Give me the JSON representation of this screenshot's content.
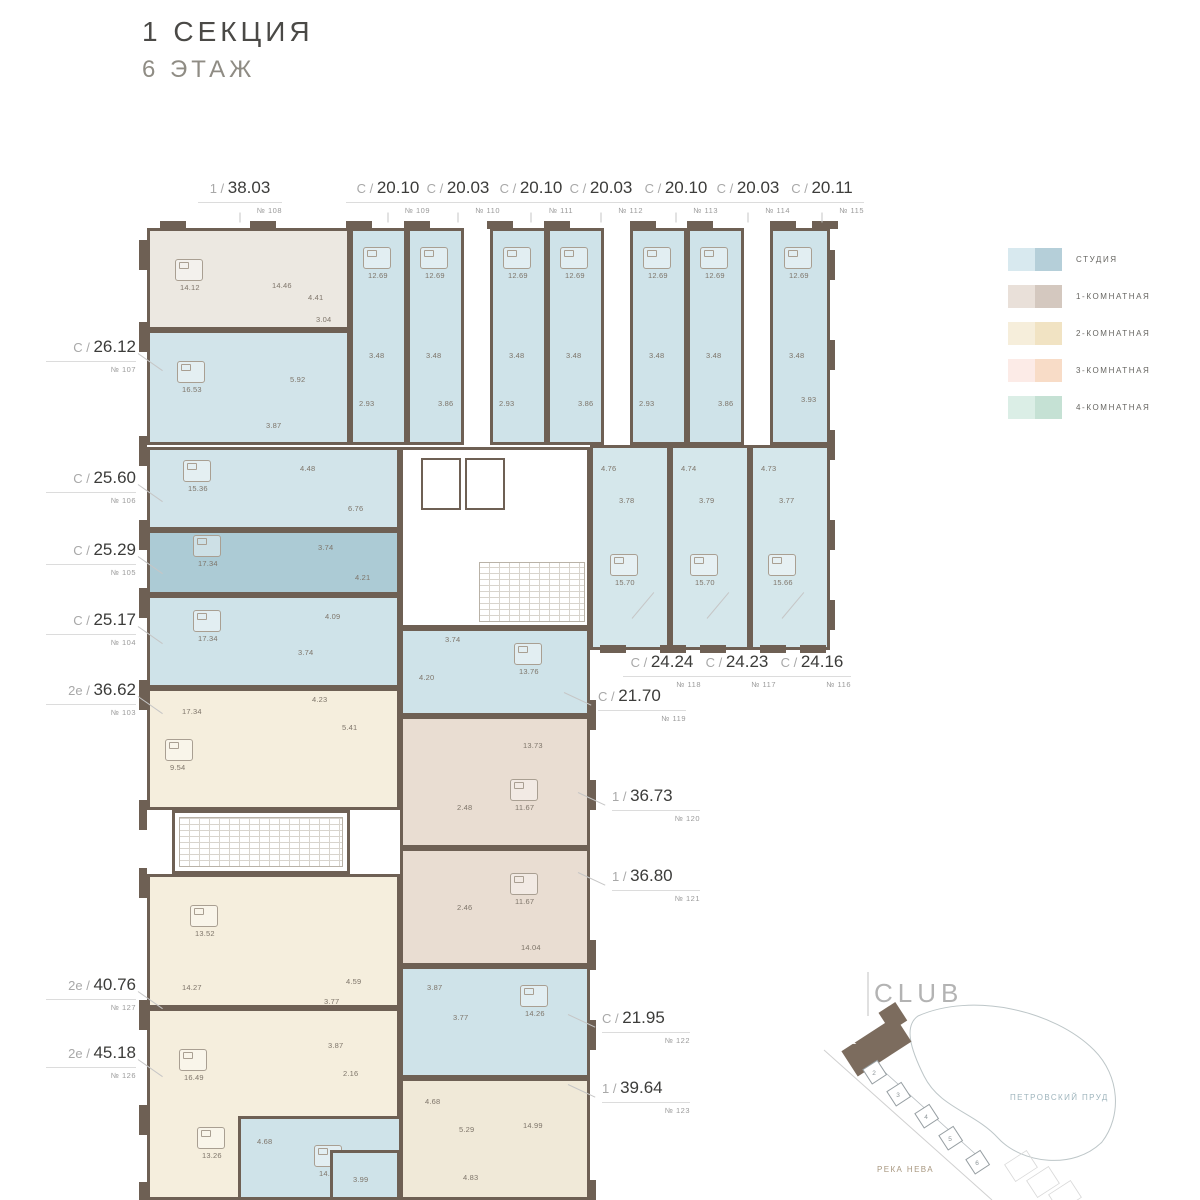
{
  "title": {
    "section": "1 СЕКЦИЯ",
    "floor": "6 ЭТАЖ"
  },
  "legend": [
    {
      "label": "СТУДИЯ",
      "colors": [
        "#d8e9ef",
        "#b5cfd9"
      ]
    },
    {
      "label": "1-КОМНАТНАЯ",
      "colors": [
        "#e9e0d9",
        "#d4c8bf"
      ]
    },
    {
      "label": "2-КОМНАТНАЯ",
      "colors": [
        "#f6eedb",
        "#f1e3c3"
      ]
    },
    {
      "label": "3-КОМНАТНАЯ",
      "colors": [
        "#fcebe7",
        "#f8dcc7"
      ]
    },
    {
      "label": "4-КОМНАТНАЯ",
      "colors": [
        "#dbeee6",
        "#c5e1d4"
      ]
    }
  ],
  "units": {
    "top": [
      {
        "id": "108",
        "prefix": "1",
        "area": "38.03",
        "num": "№ 108",
        "x": 240
      },
      {
        "id": "109",
        "prefix": "С",
        "area": "20.10",
        "num": "№ 109",
        "x": 388
      },
      {
        "id": "110",
        "prefix": "С",
        "area": "20.03",
        "num": "№ 110",
        "x": 458
      },
      {
        "id": "111",
        "prefix": "С",
        "area": "20.10",
        "num": "№ 111",
        "x": 531
      },
      {
        "id": "112",
        "prefix": "С",
        "area": "20.03",
        "num": "№ 112",
        "x": 601
      },
      {
        "id": "113",
        "prefix": "С",
        "area": "20.10",
        "num": "№ 113",
        "x": 676
      },
      {
        "id": "114",
        "prefix": "С",
        "area": "20.03",
        "num": "№ 114",
        "x": 748
      },
      {
        "id": "115",
        "prefix": "С",
        "area": "20.11",
        "num": "№ 115",
        "x": 822
      }
    ],
    "left": [
      {
        "id": "107",
        "prefix": "С",
        "area": "26.12",
        "num": "№ 107",
        "y": 337
      },
      {
        "id": "106",
        "prefix": "С",
        "area": "25.60",
        "num": "№ 106",
        "y": 468
      },
      {
        "id": "105",
        "prefix": "С",
        "area": "25.29",
        "num": "№ 105",
        "y": 540
      },
      {
        "id": "104",
        "prefix": "С",
        "area": "25.17",
        "num": "№ 104",
        "y": 610
      },
      {
        "id": "103",
        "prefix": "2е",
        "area": "36.62",
        "num": "№ 103",
        "y": 680
      },
      {
        "id": "127",
        "prefix": "2е",
        "area": "40.76",
        "num": "№ 127",
        "y": 975
      },
      {
        "id": "126",
        "prefix": "2е",
        "area": "45.18",
        "num": "№ 126",
        "y": 1043
      }
    ],
    "right_row": [
      {
        "id": "118",
        "prefix": "С",
        "area": "24.24",
        "num": "№ 118",
        "x": 662,
        "y": 652
      },
      {
        "id": "117",
        "prefix": "С",
        "area": "24.23",
        "num": "№ 117",
        "x": 737,
        "y": 652
      },
      {
        "id": "116",
        "prefix": "С",
        "area": "24.16",
        "num": "№ 116",
        "x": 812,
        "y": 652
      }
    ],
    "right_col": [
      {
        "id": "119",
        "prefix": "С",
        "area": "21.70",
        "num": "№ 119",
        "x": 598,
        "y": 686
      },
      {
        "id": "120",
        "prefix": "1",
        "area": "36.73",
        "num": "№ 120",
        "x": 612,
        "y": 786
      },
      {
        "id": "121",
        "prefix": "1",
        "area": "36.80",
        "num": "№ 121",
        "x": 612,
        "y": 866
      },
      {
        "id": "122",
        "prefix": "С",
        "area": "21.95",
        "num": "№ 122",
        "x": 602,
        "y": 1008
      },
      {
        "id": "123",
        "prefix": "1",
        "area": "39.64",
        "num": "№ 123",
        "x": 602,
        "y": 1078
      }
    ]
  },
  "plan": {
    "wall": "#6e6054",
    "blocks": [
      {
        "id": "108",
        "color": "#ece8e1",
        "x": 147,
        "y": 228,
        "w": 203,
        "h": 102,
        "rooms": [
          {
            "v": "14.12",
            "x": 30,
            "y": 52,
            "bed": true
          },
          {
            "v": "14.46",
            "x": 122,
            "y": 50
          },
          {
            "v": "4.41",
            "x": 158,
            "y": 62
          },
          {
            "v": "3.04",
            "x": 166,
            "y": 84
          }
        ]
      },
      {
        "id": "107",
        "color": "#d2e4ea",
        "x": 147,
        "y": 330,
        "w": 203,
        "h": 115,
        "rooms": [
          {
            "v": "16.53",
            "x": 32,
            "y": 52,
            "bed": true
          },
          {
            "v": "5.92",
            "x": 140,
            "y": 42
          },
          {
            "v": "3.87",
            "x": 116,
            "y": 88
          }
        ]
      },
      {
        "id": "109",
        "color": "#cfe3e9",
        "x": 350,
        "y": 228,
        "w": 57,
        "h": 217,
        "rooms": [
          {
            "v": "12.69",
            "x": 15,
            "y": 40,
            "bed": true
          },
          {
            "v": "3.48",
            "x": 16,
            "y": 120
          },
          {
            "v": "2.93",
            "x": 6,
            "y": 168
          }
        ]
      },
      {
        "id": "110",
        "color": "#cfe3e9",
        "x": 407,
        "y": 228,
        "w": 57,
        "h": 217,
        "rooms": [
          {
            "v": "12.69",
            "x": 15,
            "y": 40,
            "bed": true
          },
          {
            "v": "3.48",
            "x": 16,
            "y": 120
          },
          {
            "v": "3.86",
            "x": 28,
            "y": 168
          }
        ]
      },
      {
        "id": "111",
        "color": "#cfe3e9",
        "x": 490,
        "y": 228,
        "w": 57,
        "h": 217,
        "rooms": [
          {
            "v": "12.69",
            "x": 15,
            "y": 40,
            "bed": true
          },
          {
            "v": "3.48",
            "x": 16,
            "y": 120
          },
          {
            "v": "2.93",
            "x": 6,
            "y": 168
          }
        ]
      },
      {
        "id": "112",
        "color": "#cfe3e9",
        "x": 547,
        "y": 228,
        "w": 57,
        "h": 217,
        "rooms": [
          {
            "v": "12.69",
            "x": 15,
            "y": 40,
            "bed": true
          },
          {
            "v": "3.48",
            "x": 16,
            "y": 120
          },
          {
            "v": "3.86",
            "x": 28,
            "y": 168
          }
        ]
      },
      {
        "id": "113",
        "color": "#cfe3e9",
        "x": 630,
        "y": 228,
        "w": 57,
        "h": 217,
        "rooms": [
          {
            "v": "12.69",
            "x": 15,
            "y": 40,
            "bed": true
          },
          {
            "v": "3.48",
            "x": 16,
            "y": 120
          },
          {
            "v": "2.93",
            "x": 6,
            "y": 168
          }
        ]
      },
      {
        "id": "114",
        "color": "#cfe3e9",
        "x": 687,
        "y": 228,
        "w": 57,
        "h": 217,
        "rooms": [
          {
            "v": "12.69",
            "x": 15,
            "y": 40,
            "bed": true
          },
          {
            "v": "3.48",
            "x": 16,
            "y": 120
          },
          {
            "v": "3.86",
            "x": 28,
            "y": 168
          }
        ]
      },
      {
        "id": "115",
        "color": "#cfe3e9",
        "x": 770,
        "y": 228,
        "w": 60,
        "h": 217,
        "rooms": [
          {
            "v": "12.69",
            "x": 16,
            "y": 40,
            "bed": true
          },
          {
            "v": "3.48",
            "x": 16,
            "y": 120
          },
          {
            "v": "3.93",
            "x": 28,
            "y": 164
          }
        ]
      },
      {
        "id": "118",
        "color": "#d5e7eb",
        "x": 590,
        "y": 445,
        "w": 80,
        "h": 205,
        "rooms": [
          {
            "v": "4.76",
            "x": 8,
            "y": 16
          },
          {
            "v": "3.78",
            "x": 26,
            "y": 48
          },
          {
            "v": "15.70",
            "x": 22,
            "y": 130,
            "bed": true
          }
        ]
      },
      {
        "id": "117",
        "color": "#d5e7eb",
        "x": 670,
        "y": 445,
        "w": 80,
        "h": 205,
        "rooms": [
          {
            "v": "4.74",
            "x": 8,
            "y": 16
          },
          {
            "v": "3.79",
            "x": 26,
            "y": 48
          },
          {
            "v": "15.70",
            "x": 22,
            "y": 130,
            "bed": true
          }
        ]
      },
      {
        "id": "116",
        "color": "#d5e7eb",
        "x": 750,
        "y": 445,
        "w": 80,
        "h": 205,
        "rooms": [
          {
            "v": "4.73",
            "x": 8,
            "y": 16
          },
          {
            "v": "3.77",
            "x": 26,
            "y": 48
          },
          {
            "v": "15.66",
            "x": 20,
            "y": 130,
            "bed": true
          }
        ]
      },
      {
        "id": "106",
        "color": "#d2e4ea",
        "x": 147,
        "y": 447,
        "w": 253,
        "h": 83,
        "rooms": [
          {
            "v": "15.36",
            "x": 38,
            "y": 34,
            "bed": true
          },
          {
            "v": "4.48",
            "x": 150,
            "y": 14
          },
          {
            "v": "6.76",
            "x": 198,
            "y": 54
          }
        ]
      },
      {
        "id": "105",
        "color": "#accbd5",
        "x": 147,
        "y": 530,
        "w": 253,
        "h": 65,
        "rooms": [
          {
            "v": "17.34",
            "x": 48,
            "y": 26,
            "bed": true
          },
          {
            "v": "3.74",
            "x": 168,
            "y": 10
          },
          {
            "v": "4.21",
            "x": 205,
            "y": 40
          }
        ]
      },
      {
        "id": "104",
        "color": "#cfe3e9",
        "x": 147,
        "y": 595,
        "w": 253,
        "h": 93,
        "rooms": [
          {
            "v": "17.34",
            "x": 48,
            "y": 36,
            "bed": true
          },
          {
            "v": "4.09",
            "x": 175,
            "y": 14
          },
          {
            "v": "3.74",
            "x": 148,
            "y": 50
          }
        ]
      },
      {
        "id": "103",
        "color": "#f5eedd",
        "x": 147,
        "y": 688,
        "w": 253,
        "h": 122,
        "rooms": [
          {
            "v": "17.34",
            "x": 32,
            "y": 16
          },
          {
            "v": "4.23",
            "x": 162,
            "y": 4
          },
          {
            "v": "5.41",
            "x": 192,
            "y": 32
          },
          {
            "v": "9.54",
            "x": 20,
            "y": 72,
            "bed": true
          }
        ]
      },
      {
        "id": "127",
        "color": "#f5eedd",
        "x": 147,
        "y": 874,
        "w": 253,
        "h": 134,
        "rooms": [
          {
            "v": "13.52",
            "x": 45,
            "y": 52,
            "bed": true
          },
          {
            "v": "14.27",
            "x": 32,
            "y": 106
          },
          {
            "v": "4.59",
            "x": 196,
            "y": 100
          },
          {
            "v": "3.77",
            "x": 174,
            "y": 120
          }
        ]
      },
      {
        "id": "126",
        "color": "#f5eedd",
        "x": 147,
        "y": 1008,
        "w": 253,
        "h": 192,
        "rooms": [
          {
            "v": "16.49",
            "x": 34,
            "y": 62,
            "bed": true
          },
          {
            "v": "3.87",
            "x": 178,
            "y": 30
          },
          {
            "v": "2.16",
            "x": 193,
            "y": 58
          },
          {
            "v": "13.26",
            "x": 52,
            "y": 140,
            "bed": true
          }
        ]
      },
      {
        "id": "core",
        "color": "#ffffff",
        "x": 400,
        "y": 447,
        "w": 190,
        "h": 181,
        "core": true
      },
      {
        "id": "stair2",
        "color": "#ffffff",
        "x": 172,
        "y": 810,
        "w": 178,
        "h": 64,
        "stairwell": true
      },
      {
        "id": "119",
        "color": "#cfe3e9",
        "x": 400,
        "y": 628,
        "w": 190,
        "h": 88,
        "rooms": [
          {
            "v": "3.74",
            "x": 42,
            "y": 4
          },
          {
            "v": "4.20",
            "x": 16,
            "y": 42
          },
          {
            "v": "13.76",
            "x": 116,
            "y": 36,
            "bed": true
          }
        ]
      },
      {
        "id": "120",
        "color": "#e9ddd2",
        "x": 400,
        "y": 716,
        "w": 190,
        "h": 132,
        "rooms": [
          {
            "v": "13.73",
            "x": 120,
            "y": 22
          },
          {
            "v": "2.48",
            "x": 54,
            "y": 84
          },
          {
            "v": "11.67",
            "x": 112,
            "y": 84,
            "bed": true
          }
        ]
      },
      {
        "id": "121",
        "color": "#e9ddd2",
        "x": 400,
        "y": 848,
        "w": 190,
        "h": 118,
        "rooms": [
          {
            "v": "2.46",
            "x": 54,
            "y": 52
          },
          {
            "v": "11.67",
            "x": 112,
            "y": 46,
            "bed": true
          },
          {
            "v": "14.04",
            "x": 118,
            "y": 92
          }
        ]
      },
      {
        "id": "122",
        "color": "#cfe3e9",
        "x": 400,
        "y": 966,
        "w": 190,
        "h": 112,
        "rooms": [
          {
            "v": "3.87",
            "x": 24,
            "y": 14
          },
          {
            "v": "3.77",
            "x": 50,
            "y": 44
          },
          {
            "v": "14.26",
            "x": 122,
            "y": 40,
            "bed": true
          }
        ]
      },
      {
        "id": "123",
        "color": "#f0e9d8",
        "x": 400,
        "y": 1078,
        "w": 190,
        "h": 122,
        "rooms": [
          {
            "v": "4.68",
            "x": 22,
            "y": 16
          },
          {
            "v": "5.29",
            "x": 56,
            "y": 44
          },
          {
            "v": "14.99",
            "x": 120,
            "y": 40
          },
          {
            "v": "4.83",
            "x": 60,
            "y": 92
          }
        ]
      },
      {
        "id": "124",
        "color": "#cfe3e9",
        "x": 238,
        "y": 1116,
        "w": 164,
        "h": 84,
        "rooms": [
          {
            "v": "4.68",
            "x": 16,
            "y": 18
          },
          {
            "v": "14.28",
            "x": 78,
            "y": 50,
            "bed": true
          }
        ]
      },
      {
        "id": "125",
        "color": "#cfe3e9",
        "x": 330,
        "y": 1150,
        "w": 70,
        "h": 50,
        "rooms": [
          {
            "v": "3.99",
            "x": 20,
            "y": 22
          }
        ]
      }
    ]
  },
  "map": {
    "club": "CLUB",
    "pond": "ПЕТРОВСКИЙ ПРУД",
    "river": "РЕКА НЕВА",
    "section_mark": "1",
    "numbers": [
      "2",
      "3",
      "4",
      "5",
      "6"
    ]
  }
}
